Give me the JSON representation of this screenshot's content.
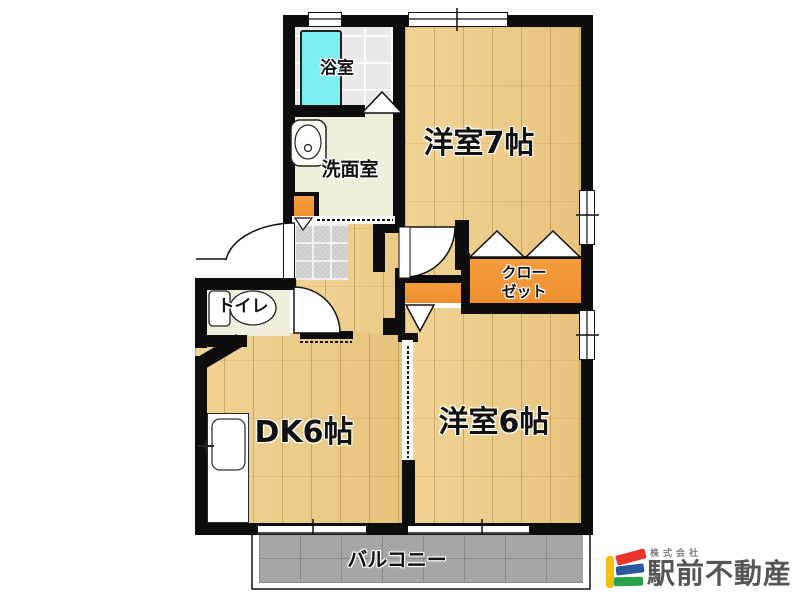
{
  "rooms": {
    "bath": {
      "label": "浴室"
    },
    "washroom": {
      "label": "洗面室"
    },
    "toilet": {
      "label": "トイレ"
    },
    "dining_kitchen": {
      "label": "DK6帖"
    },
    "western_room_7": {
      "label": "洋室7帖"
    },
    "western_room_6": {
      "label": "洋室6帖"
    },
    "closet": {
      "label_line1": "クロー",
      "label_line2": "ゼット"
    },
    "balcony": {
      "label": "バルコニー"
    }
  },
  "branding": {
    "company_type": "株式会社",
    "company_name": "駅前不動産",
    "logo_colors": {
      "bar": "#f2c10e",
      "stripe_top": "#e7342c",
      "stripe_middle": "#2b56a2",
      "stripe_bottom": "#27a24b"
    }
  },
  "palette": {
    "wall": "#0d0d0d",
    "wood_floor": "#ecca85",
    "bath_tile": "#e9e9e9",
    "bathtub": "#7deef2",
    "cream_floor": "#f1efdb",
    "closet_orange": "#ef9434",
    "entry_tile": "#d8d8d8",
    "balcony_tile": "#a8a8a8"
  }
}
